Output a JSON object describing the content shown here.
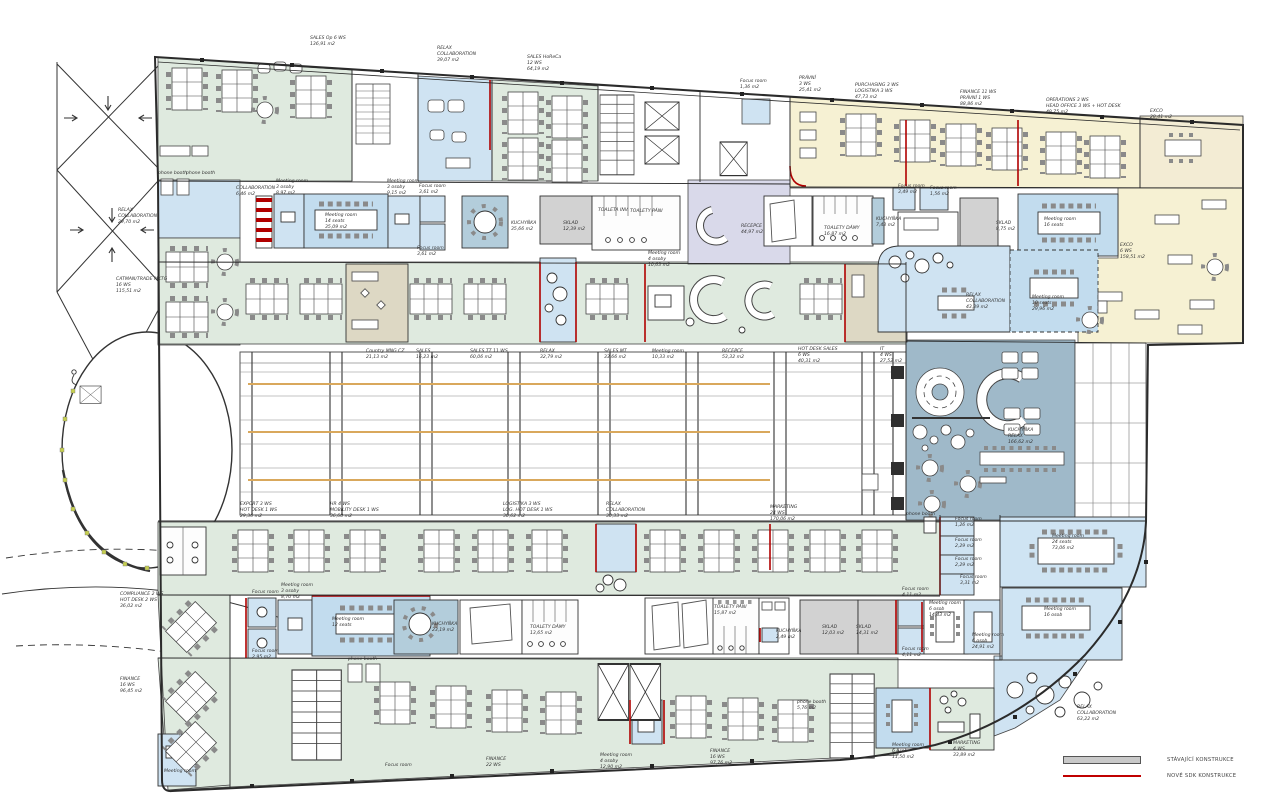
{
  "title": "Office floor plan",
  "colors": {
    "open_office_green": "#dfeadf",
    "relax_blue": "#cfe3f2",
    "meeting_blue": "#c2dcee",
    "office_yellow": "#f6f1d3",
    "exco_cream": "#f3ecd4",
    "kitchen_slate": "#9fb9c9",
    "kitchen_slate_light": "#b3cddb",
    "storage_gray": "#d2d2d2",
    "reception_lavender": "#d9d9ea",
    "tan_beige": "#ddd8c4",
    "new_partition_red": "#b00000",
    "accent_orange": "#d9a85c"
  },
  "legend": {
    "items": [
      {
        "label": "STÁVAJÍCÍ KONSTRUKCE",
        "swatch": "gray-bar"
      },
      {
        "label": "NOVÉ SDK KONSTRUKCE",
        "swatch": "red-line"
      }
    ]
  },
  "labels": [
    "SALES Op 6 WS\n136,91 m2",
    "RELAX\nCOLLABORATION\n39,07 m2",
    "SALES HoReCa\n12 WS\n64,19 m2",
    "Focus room\n1,36 m2",
    "PRÁVNÍ\n3 WS\n25,41 m2",
    "PURCHASING 3 WS\nLOGISTIKA 3 WS\n47,73 m2",
    "FINANCE 11 WS\nPRÁVNÍ 1 WS\n88,86 m2",
    "OPERATIONS 3 WS\nHEAD OFFICE 3 WS + HOT DESK\n49,75 m2",
    "EXCO\n28,41 m2",
    "phone booth",
    "phone booth",
    "COLLABORATION\n6,46 m2",
    "Meeting room\n3 osoby\n8,97 m2",
    "Meeting room\n14 seats\n35,09 m2",
    "Meeting room\n3 osoby\n9,15 m2",
    "Focus room\n3,61 m2",
    "Focus room\n3,61 m2",
    "KUCHYŇKA\n35,66 m2",
    "SKLAD\n12,39 m2",
    "TOALETA INV.",
    "TOALETY PÁNI",
    "RECEPCE\n44,97 m2",
    "TOALETY DÁMY\n16,87 m2",
    "KUCHYŇKA\n7,43 m2",
    "Focus room\n3,49 m2",
    "Focus room\n1,56 m2",
    "SKLAD\n8,75 m2",
    "Meeting room\n16 seats",
    "EXCO\n6 WS\n158,51 m2",
    "Meeting room\n4 osoby\n10,63 m2",
    "RELAX\nCOLLABORATION\n43,39 m2",
    "Meeting room\n10 seats\n29,96 m2",
    "RELAX\nCOLLABORATION\n29,70 m2",
    "CATMAN/TRADE MKTG\n16 WS\n115,51 m2",
    "Country MNG CZ\n21,13 m2",
    "SALES\n16,23 m2",
    "SALES TT 11 WS\n60,06 m2",
    "RELAX\n32,79 m2",
    "SALES MT\n33,66 m2",
    "Meeting room\n10,33 m2",
    "RECEPCE\n53,32 m2",
    "HOT DESK SALES\n6 WS\n40,31 m2",
    "IT\n4 WS\n27,52 m2",
    "KUCHYŇKA\nRELAX\n166,62 m2",
    "EXPORT 3 WS\nHOT DESK 1 WS\n29,36 m2",
    "HR 4 WS\nMOBILITY DESK 1 WS\n36,60 m2",
    "LOGISTIKA 3 WS\nLOG. HOT DESK 1 WS\n30,62 m2",
    "RELAX\nCOLLABORATION\n30,33 m2",
    "MARKETING\n24 WS\n170,06 m2",
    "COMPLIANCE 2 WS\nHOT DESK 2 WS\n36,02 m2",
    "FINANCE\n16 WS\n96,45 m2",
    "Focus room",
    "Meeting room\n3 osoby\n8,70 m2",
    "Meeting room\n12 seats",
    "Focus room\n2,95 m2",
    "phone booth",
    "phone booth\n5,76 m2",
    "KUCHYŇKA\n23,19 m2",
    "TOALETY DÁMY\n13,65 m2",
    "TOALETY PÁNI\n15,87 m2",
    "KUCHYŇKA\n2,49 m2",
    "SKLAD\n12,03 m2",
    "SKLAD\n14,31 m2",
    "Focus room\n4,11 m2",
    "Focus room\n4,11 m2",
    "Meeting room\n6 osob\n14,43 m2",
    "Meeting room\n6 osob\n24,91 m2",
    "Meeting room\n16 osob",
    "Focus room\n1,26 m2",
    "Focus room\n2,29 m2",
    "Focus room\n2,29 m2",
    "Focus room\n3,31 m2",
    "phone booth",
    "Meeting room\n24 seats\n73,06 m2",
    "Meeting room",
    "Focus room",
    "FINANCE\n22 WS",
    "Meeting room\n4 osoby\n12,90 m2",
    "FINANCE\n16 WS\n97,76 m2",
    "Meeting room\n6 osob\n11,50 m2",
    "MARKETING\n4 WS\n33,89 m2",
    "RELAX\nCOLLABORATION\n63,22 m2"
  ]
}
